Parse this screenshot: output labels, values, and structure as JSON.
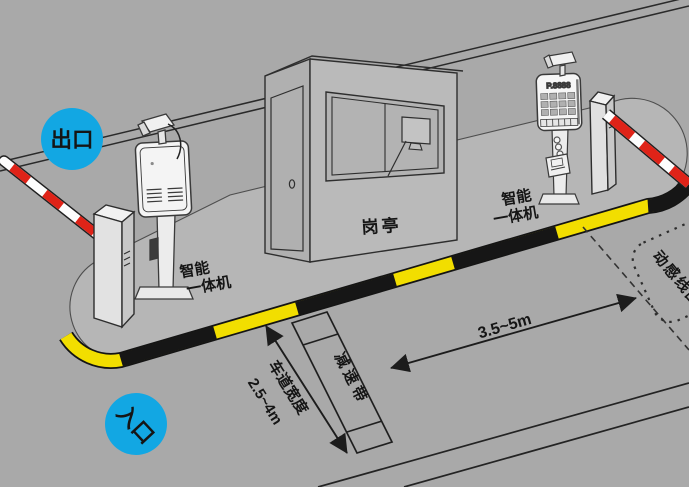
{
  "badges": {
    "exit": "出口",
    "entrance": "入口"
  },
  "booth": {
    "label": "岗亭"
  },
  "terminals": {
    "label_line1": "智能",
    "label_line2": "一体机",
    "led_display": "P.8888"
  },
  "roadway": {
    "speed_bump": "减速带",
    "lane_width_label": "车道宽度",
    "lane_width_value": "2.5~4m",
    "coil_distance_value": "3.5~5m",
    "induction_coil": "动感线圈"
  },
  "colors": {
    "road": "#a9a9a9",
    "island": "#b6b6b6",
    "curb_yellow": "#f2de00",
    "curb_black": "#161616",
    "badge_blue": "#12a7e3",
    "arm_red": "#df2318",
    "ink": "#262626"
  }
}
